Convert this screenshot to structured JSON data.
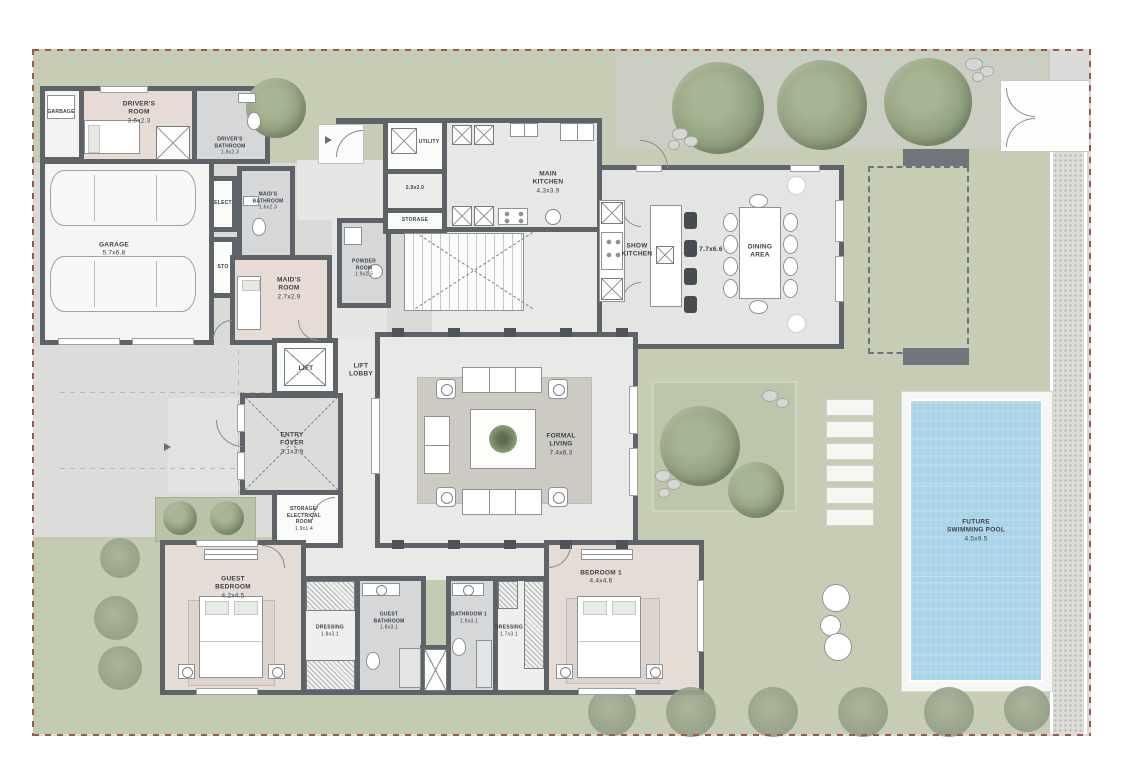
{
  "drawing": {
    "type": "villa-ground-floor-plan",
    "colors": {
      "wall": "#5e6367",
      "lawn": "#c6cdb4",
      "paving": "#dcddda",
      "bedroom_floor": "#e6dcd5",
      "bathroom_floor": "#d6d7d9",
      "hall_floor": "#e9eae8",
      "pool_water": "#a9d3e8",
      "boundary": "#9b5a50",
      "tree": "#93a37f"
    }
  },
  "rooms": {
    "garbage": {
      "name": "GARBAGE",
      "dims": ""
    },
    "drivers_room": {
      "name": "DRIVER'S\nROOM",
      "dims": "3.6x2.3"
    },
    "drivers_bathroom": {
      "name": "DRIVER'S\nBATHROOM",
      "dims": "1.8x2.3"
    },
    "garage": {
      "name": "GARAGE",
      "dims": "5.7x6.8"
    },
    "elect": {
      "name": "ELECT",
      "dims": ""
    },
    "sto": {
      "name": "STO",
      "dims": ""
    },
    "maids_bathroom": {
      "name": "MAID'S\nBATHROOM",
      "dims": "1.6x2.3"
    },
    "maids_room": {
      "name": "MAID'S\nROOM",
      "dims": "2.7x2.9"
    },
    "powder_room": {
      "name": "POWDER\nROOM",
      "dims": "1.9x2.5"
    },
    "utility": {
      "name": "UTILITY",
      "dims": ""
    },
    "corridor": {
      "name": "2.0x2.0",
      "dims": ""
    },
    "storage": {
      "name": "STORAGE",
      "dims": ""
    },
    "main_kitchen": {
      "name": "MAIN\nKITCHEN",
      "dims": "4.3x3.9"
    },
    "show_kitchen": {
      "name": "SHOW\nKITCHEN",
      "dims": ""
    },
    "dining_dims": {
      "name": "7.7x6.6",
      "dims": ""
    },
    "dining_area": {
      "name": "DINING\nAREA",
      "dims": ""
    },
    "lift": {
      "name": "LIFT",
      "dims": ""
    },
    "lift_lobby": {
      "name": "LIFT\nLOBBY",
      "dims": ""
    },
    "entry_foyer": {
      "name": "ENTRY\nFOYER",
      "dims": "3.1x3.9"
    },
    "storage_electrical": {
      "name": "STORAGE/\nELECTRICAL\nROOM",
      "dims": "1.9x1.4"
    },
    "formal_living": {
      "name": "FORMAL\nLIVING",
      "dims": "7.4x6.3"
    },
    "guest_bedroom": {
      "name": "GUEST\nBEDROOM",
      "dims": "4.2x4.5"
    },
    "dressing_guest": {
      "name": "DRESSING",
      "dims": "1.8x3.1"
    },
    "guest_bathroom": {
      "name": "GUEST\nBATHROOM",
      "dims": "1.8x3.1"
    },
    "bathroom_1": {
      "name": "BATHROOM 1",
      "dims": "1.9x3.1"
    },
    "dressing_1": {
      "name": "DRESSING",
      "dims": "1.7x3.1"
    },
    "bedroom_1": {
      "name": "BEDROOM 1",
      "dims": "4.4x4.6"
    },
    "pool": {
      "name": "FUTURE\nSWIMMING POOL",
      "dims": "4.5x9.5"
    }
  }
}
